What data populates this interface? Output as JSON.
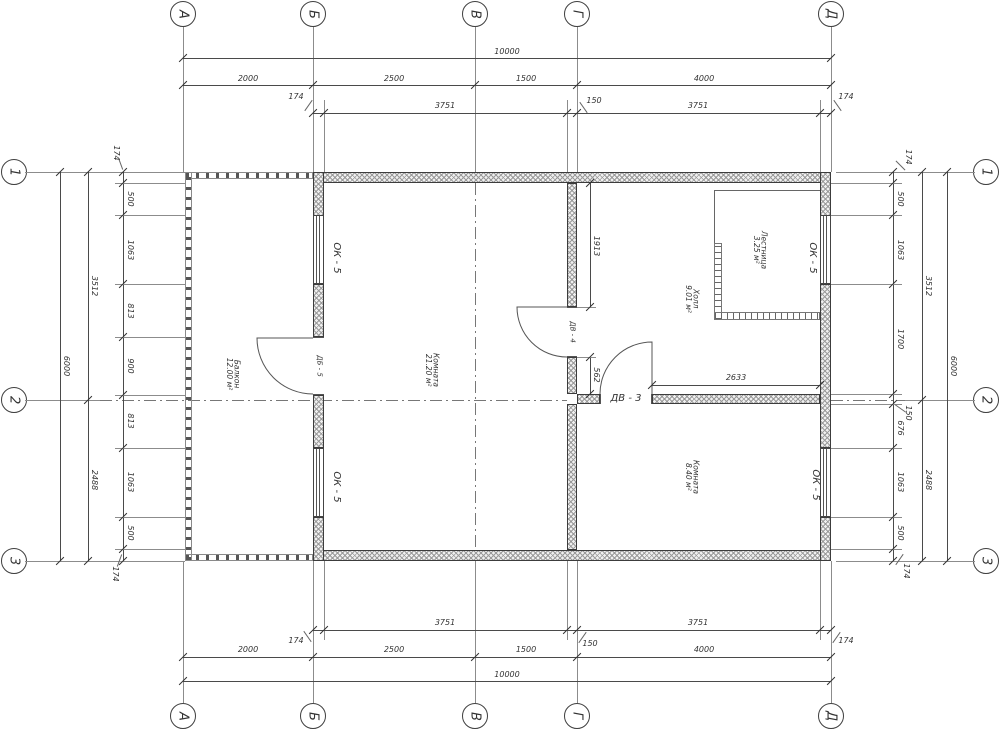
{
  "title": "Floor plan drawing",
  "colors": {
    "line": "#444444",
    "hatch": "#9b9b9b",
    "background": "#ffffff"
  },
  "axes": {
    "top": [
      "А",
      "Б",
      "В",
      "Г",
      "Д"
    ],
    "bottom": [
      "А",
      "Б",
      "В",
      "Г",
      "Д"
    ],
    "left": [
      "1",
      "2",
      "3"
    ],
    "right": [
      "1",
      "2",
      "3"
    ]
  },
  "dims": {
    "overall_h": "10000",
    "overall_v": "6000",
    "top_segments": [
      "2000",
      "2500",
      "1500",
      "4000"
    ],
    "top_chain": [
      "174",
      "3751",
      "150",
      "3751",
      "174"
    ],
    "bottom_segments": [
      "2000",
      "2500",
      "1500",
      "4000"
    ],
    "bottom_chain": [
      "174",
      "3751",
      "150",
      "3751",
      "174"
    ],
    "left_mid": [
      "3512",
      "2488"
    ],
    "left_chain": [
      "174",
      "500",
      "1063",
      "813",
      "900",
      "813",
      "1063",
      "500",
      "174"
    ],
    "right_mid": [
      "3512",
      "2488"
    ],
    "right_chain": [
      "174",
      "500",
      "1063",
      "1700",
      "150",
      "676",
      "1063",
      "500",
      "174"
    ],
    "interior": {
      "door4_top": "1913",
      "door4_bottom": "562",
      "hall_width": "2633"
    }
  },
  "rooms": [
    {
      "name": "Комната",
      "area": "21.20 м²"
    },
    {
      "name": "Балкон",
      "area": "12.00 м²"
    },
    {
      "name": "Холл",
      "area": "9.01 м²"
    },
    {
      "name": "Лестница",
      "area": "3.25 м²"
    },
    {
      "name": "Комната",
      "area": "8.40 м²"
    }
  ],
  "openings": {
    "window_labels": [
      "ОК - 5",
      "ОК - 5",
      "ОК - 5",
      "ОК - 5"
    ],
    "door_labels": [
      "ДБ - 5",
      "ДВ - 4",
      "ДВ - 3"
    ]
  }
}
